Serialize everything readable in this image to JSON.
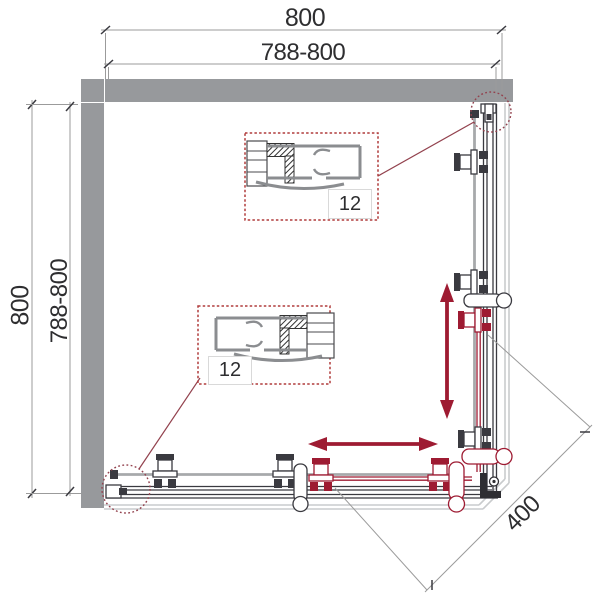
{
  "dimensions": {
    "top_outer": "800",
    "top_inner": "788-800",
    "left_outer": "800",
    "left_inner": "788-800",
    "diagonal_opening": "400"
  },
  "details": {
    "top_callout_label": "12",
    "bottom_callout_label": "12"
  },
  "colors": {
    "wall_gray": "#97999c",
    "line_dark": "#3a3a40",
    "dim_gray": "#9b9b9b",
    "tray_gray": "#c9cbcd",
    "rail_gray": "#a7a9ab",
    "profile_gray": "#8b8d90",
    "accent_red": "#9e1b32",
    "callout_red": "#b03c3c",
    "detail_red": "#93424e",
    "text_dark": "#2e2e30",
    "background": "#ffffff"
  }
}
